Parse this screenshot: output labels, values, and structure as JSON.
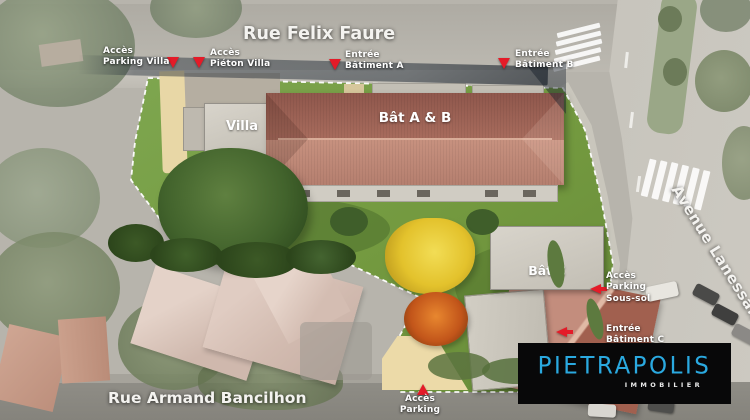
{
  "streets": {
    "top": "Rue Felix Faure",
    "bottom": "Rue Armand Bancilhon",
    "right": "Avenue Lanessan"
  },
  "buildings": {
    "villa": "Villa",
    "bat_ab": "Bât A & B",
    "bat_c": "Bât C"
  },
  "access_points": {
    "parking_villa": "Accès\nParking Villa",
    "pieton_villa": "Accès\nPiéton Villa",
    "entree_bat_a": "Entrée\nBâtiment A",
    "entree_bat_b": "Entrée\nBâtiment B",
    "parking_sous_sol": "Accès\nParking\nSous-sol",
    "entree_bat_c": "Entrée\nBâtiment C",
    "acces_parking": "Accès\nParking"
  },
  "logo": {
    "brand": "PIETRAPOLIS",
    "tagline": "IMMOBILIER"
  },
  "colors": {
    "marker_red": "#e41b28",
    "brand_blue": "#2aa9e0",
    "grass_green": "#74993f",
    "roof_terracotta": "#b07a6c"
  }
}
